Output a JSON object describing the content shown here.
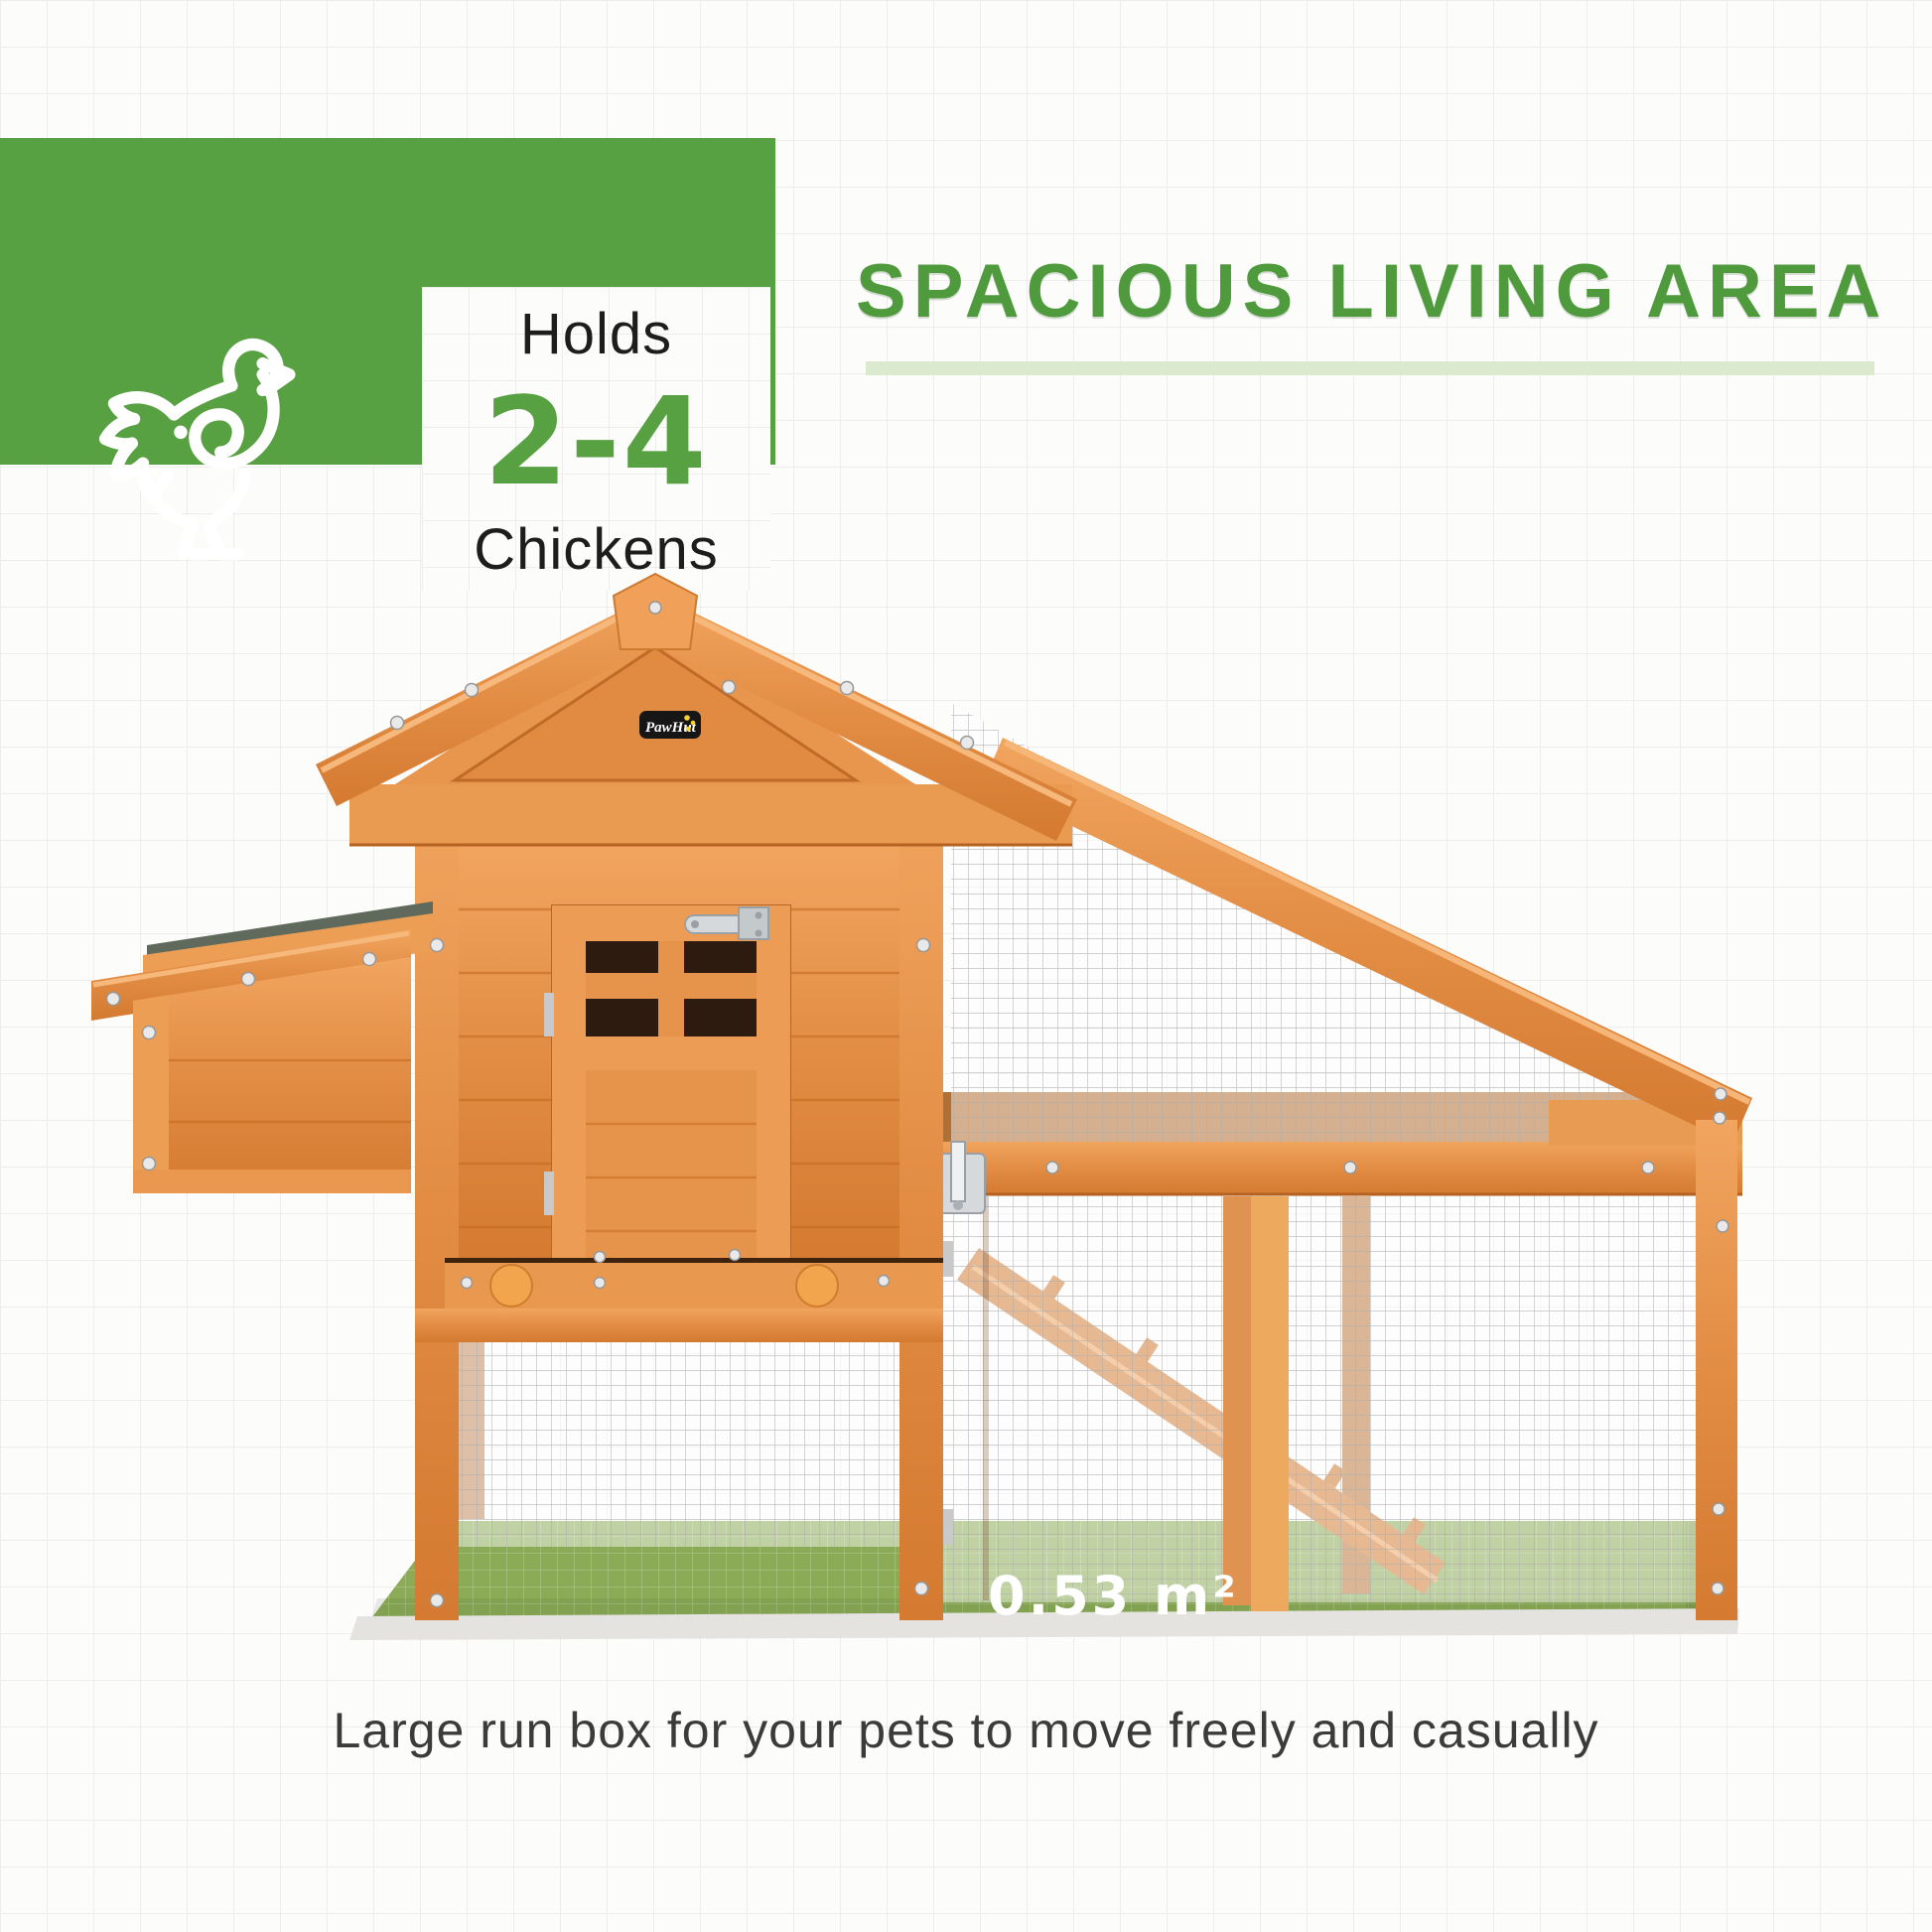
{
  "badge": {
    "holds_label": "Holds",
    "capacity": "2-4",
    "unit_label": "Chickens",
    "icon": "chicken-icon"
  },
  "heading": {
    "title": "SPACIOUS LIVING AREA"
  },
  "product": {
    "brand_logo": "PawHut",
    "floor_area_label": "0.53 m²"
  },
  "caption": {
    "text": "Large run box for your pets to move freely and casually"
  },
  "colors": {
    "brand_green": "#58A143",
    "heading_green": "#4F9A3D",
    "underline_green": "#DBE9CF",
    "wood_orange": "#E28C44",
    "roof_felt_gray": "#5F6A5C",
    "floor_green": "#8CAB57",
    "knob_orange": "#F3A54D",
    "mesh_gray": "#ADADAD"
  }
}
